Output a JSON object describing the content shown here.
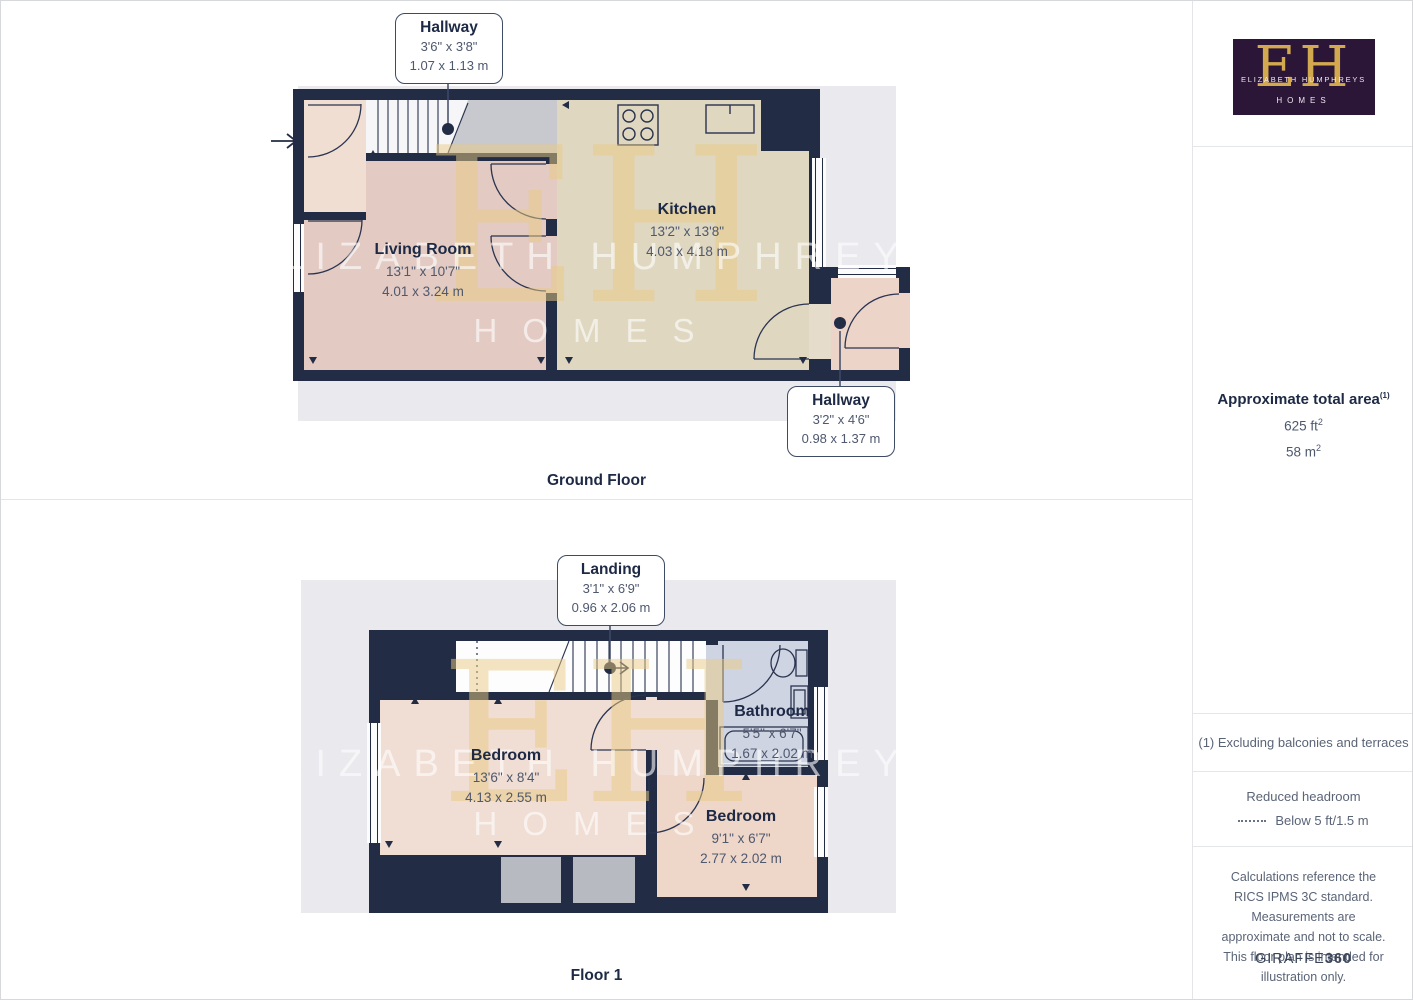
{
  "palette": {
    "wall": "#232c45",
    "living_room_fill": "#e3cac2",
    "kitchen_fill": "#dfd7c0",
    "hallway_fill": "#f1ded3",
    "bedroom_fill": "#f0ddd3",
    "bathroom_fill": "#ced4e2",
    "closet_fill": "#b7bac1",
    "backdrop": "#e9e9ee",
    "label_navy": "#1d2945",
    "dim_gray": "#4e586e",
    "logo_purple": "#2b1638",
    "logo_gold": "#d3a94f",
    "watermark_gold": "rgba(234,201,130,0.5)"
  },
  "watermark": {
    "monogram": "EH",
    "line1": "ELIZABETH HUMPHREYS",
    "line2": "HOMES"
  },
  "ground_floor": {
    "caption": "Ground Floor",
    "callout_stairs": {
      "name": "Hallway",
      "imperial": "3'6\" x 3'8\"",
      "metric": "1.07 x 1.13 m"
    },
    "callout_rear": {
      "name": "Hallway",
      "imperial": "3'2\" x 4'6\"",
      "metric": "0.98 x 1.37 m"
    },
    "living_room": {
      "name": "Living Room",
      "imperial": "13'1\" x 10'7\"",
      "metric": "4.01 x 3.24 m"
    },
    "kitchen": {
      "name": "Kitchen",
      "imperial": "13'2\" x 13'8\"",
      "metric": "4.03 x 4.18 m"
    }
  },
  "floor1": {
    "caption": "Floor 1",
    "callout_landing": {
      "name": "Landing",
      "imperial": "3'1\" x 6'9\"",
      "metric": "0.96 x 2.06 m"
    },
    "bedroom1": {
      "name": "Bedroom",
      "imperial": "13'6\" x 8'4\"",
      "metric": "4.13 x 2.55 m"
    },
    "bathroom": {
      "name": "Bathroom",
      "imperial": "5'5\" x 6'7\"",
      "metric": "1.67 x 2.02 m"
    },
    "bedroom2": {
      "name": "Bedroom",
      "imperial": "9'1\" x 6'7\"",
      "metric": "2.77 x 2.02 m"
    }
  },
  "sidebar": {
    "logo": {
      "monogram": "EH",
      "name": "ELIZABETH HUMPHREYS",
      "homes": "HOMES"
    },
    "area": {
      "title": "Approximate total area",
      "title_sup": "(1)",
      "ft_value": "625 ft",
      "ft_sup": "2",
      "m_value": "58 m",
      "m_sup": "2"
    },
    "footnote": "(1) Excluding balconies and terraces",
    "headroom": {
      "title": "Reduced headroom",
      "legend": "Below 5 ft/1.5 m"
    },
    "disclaimer": "Calculations reference the RICS IPMS 3C standard. Measurements are approximate and not to scale. This floor plan is intended for illustration only.",
    "brand": {
      "name": "GIRAFFE",
      "suffix": "360"
    }
  }
}
